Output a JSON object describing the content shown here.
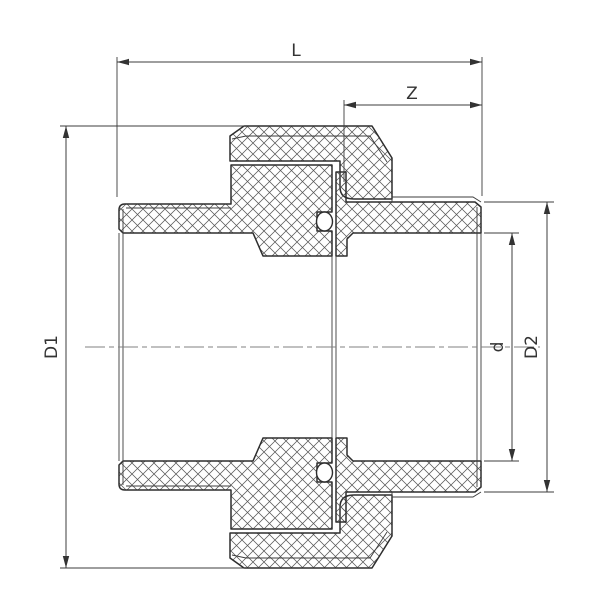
{
  "figure": {
    "background": "#ffffff",
    "line_color": "#2e2e2e",
    "thin_line_color": "#3c3c3c",
    "hatch_color": "#555555",
    "centerline_color": "#808080"
  },
  "dimensions": {
    "overall_length": "L",
    "engagement_length": "Z",
    "left_outer_diameter": "D1",
    "right_outer_diameter": "D2",
    "bore_diameter": "d"
  }
}
